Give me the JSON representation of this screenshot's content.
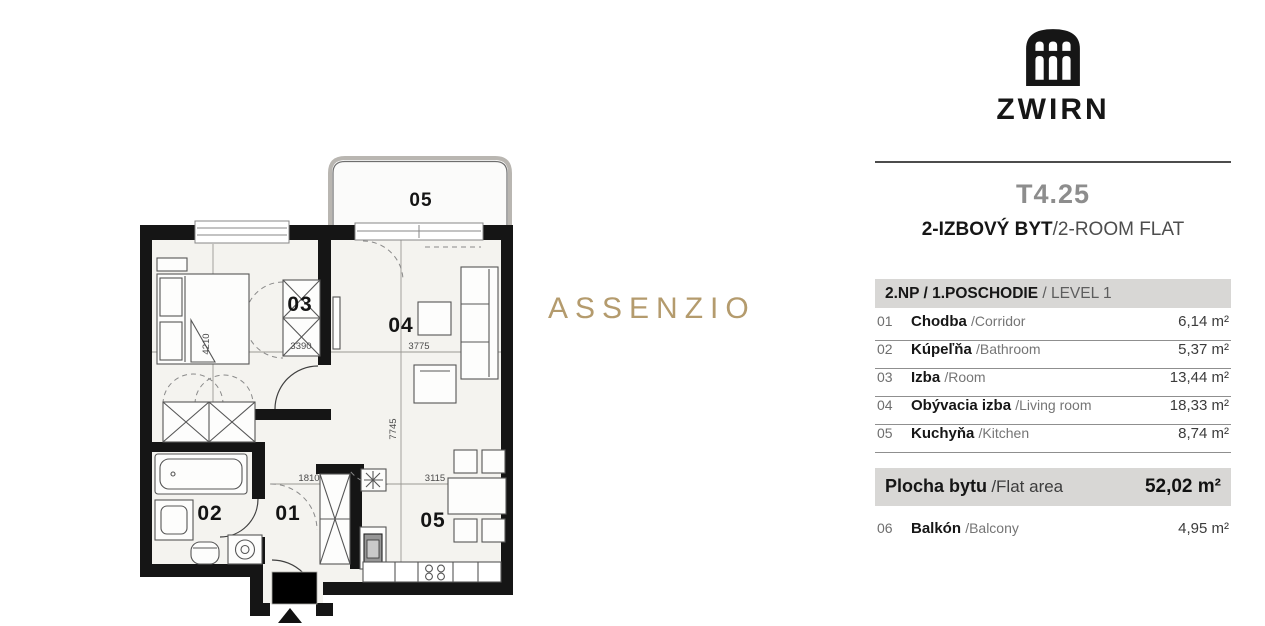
{
  "watermark": "ASSENZIO",
  "brand": {
    "name": "ZWIRN",
    "logo": "arched-windows-building"
  },
  "unit": {
    "code": "T4.25",
    "type_sk": "2-IZBOVÝ BYT",
    "type_en": "/2-ROOM FLAT"
  },
  "level": {
    "sk": "2.NP / 1.POSCHODIE",
    "en": "/ LEVEL 1"
  },
  "rooms": [
    {
      "num": "01",
      "sk": "Chodba",
      "en": "/Corridor",
      "area": "6,14 m²"
    },
    {
      "num": "02",
      "sk": "Kúpeľňa",
      "en": "/Bathroom",
      "area": "5,37 m²"
    },
    {
      "num": "03",
      "sk": "Izba",
      "en": "/Room",
      "area": "13,44 m²"
    },
    {
      "num": "04",
      "sk": "Obývacia izba",
      "en": "/Living room",
      "area": "18,33 m²"
    },
    {
      "num": "05",
      "sk": "Kuchyňa",
      "en": "/Kitchen",
      "area": "8,74 m²"
    }
  ],
  "total": {
    "sk": "Plocha bytu",
    "en": "/Flat area",
    "area": "52,02 m²"
  },
  "extra": {
    "num": "06",
    "sk": "Balkón",
    "en": "/Balcony",
    "area": "4,95 m²"
  },
  "plan": {
    "labels": {
      "balcony": "05",
      "room03": "03",
      "room04": "04",
      "corridor": "01",
      "bathroom": "02",
      "kitchen": "05"
    },
    "dims": {
      "room03_h": "4210",
      "room03_w": "3390",
      "room04_w": "3775",
      "room04_h": "7745",
      "corridor_w": "1810",
      "kitchen_w": "3115"
    }
  }
}
